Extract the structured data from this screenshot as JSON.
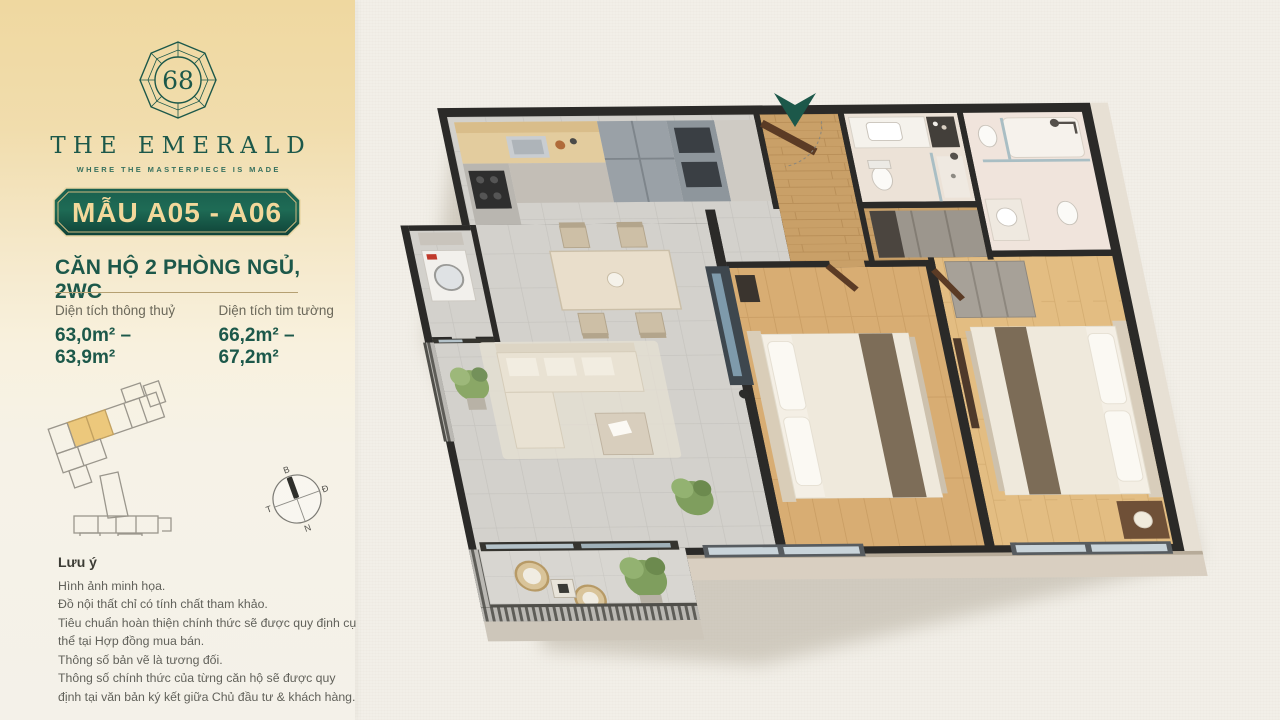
{
  "brand": {
    "logo_number": "68",
    "name": "THE EMERALD",
    "tagline": "WHERE THE MASTERPIECE IS MADE"
  },
  "badge": {
    "label": "MẪU A05 - A06"
  },
  "unit": {
    "title": "CĂN HỘ 2 PHÒNG NGỦ, 2WC"
  },
  "specs": [
    {
      "label": "Diện tích thông thuỷ",
      "value": "63,0m² – 63,9m²"
    },
    {
      "label": "Diện tích tim tường",
      "value": "66,2m² – 67,2m²"
    }
  ],
  "compass": {
    "north": "B",
    "east": "Đ",
    "south": "N",
    "west": "T"
  },
  "notes": {
    "title": "Lưu ý",
    "lines": [
      "Hình ảnh minh họa.",
      "Đồ nội thất chỉ có tính chất tham khảo.",
      "Tiêu chuẩn hoàn thiện chính thức sẽ được quy định cụ thể tại Hợp đồng mua bán.",
      "Thông số bản vẽ là tương đối.",
      "Thông số chính thức của từng căn hộ sẽ được quy định tại văn bản ký kết giữa Chủ đầu tư & khách hàng."
    ]
  },
  "floor_plan": {
    "highlighted_units": "A05-A06",
    "entrance_marker": "entrance-arrow"
  },
  "colors": {
    "emerald": "#1c584a",
    "gold_text": "#f3d89b",
    "sidebar_gold": "#efd8a0",
    "paper": "#f2efe8",
    "unit_highlight": "#ecc87c"
  }
}
